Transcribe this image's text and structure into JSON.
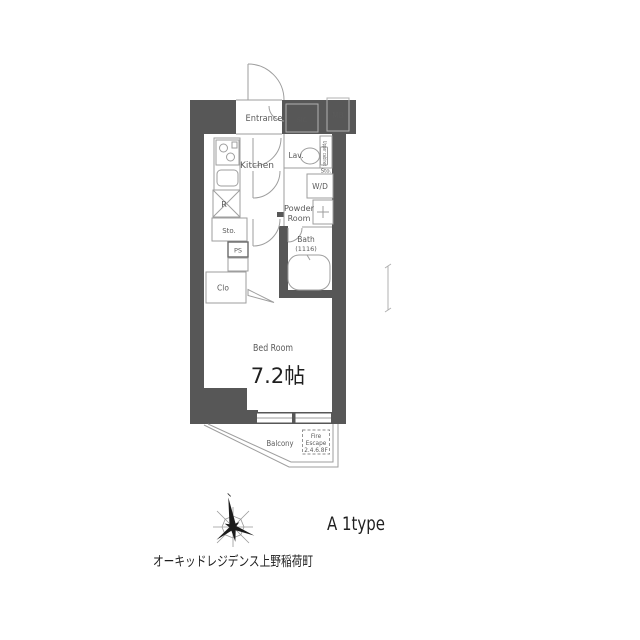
{
  "colors": {
    "wall": "#575757",
    "thin_line": "#9e9e9e",
    "label_text": "#5a5a5a",
    "dark_text": "#1f1f1f"
  },
  "plan": {
    "entrance": "Entrance",
    "sic": "SIC",
    "mb": "MB",
    "kitchen": "Kitchen",
    "lav": "Lav.",
    "upper_cabinet": "Upper cabinet",
    "sto_above_wd": "Sto.",
    "wd": "W/D",
    "powder_1": "Powder",
    "powder_2": "Room",
    "refrigerator": "R",
    "storage": "Sto.",
    "ps": "PS",
    "closet": "Clo",
    "bath_1": "Bath",
    "bath_2": "(1116)",
    "bedroom": "Bed Room",
    "bedroom_size": "7.2帖",
    "balcony": "Balcony",
    "fire_1": "Fire",
    "fire_2": "Escape",
    "fire_3": "2.4.6.8F"
  },
  "footer": {
    "plan_type": "A 1type",
    "building_name": "オーキッドレジデンス上野稲荷町"
  }
}
